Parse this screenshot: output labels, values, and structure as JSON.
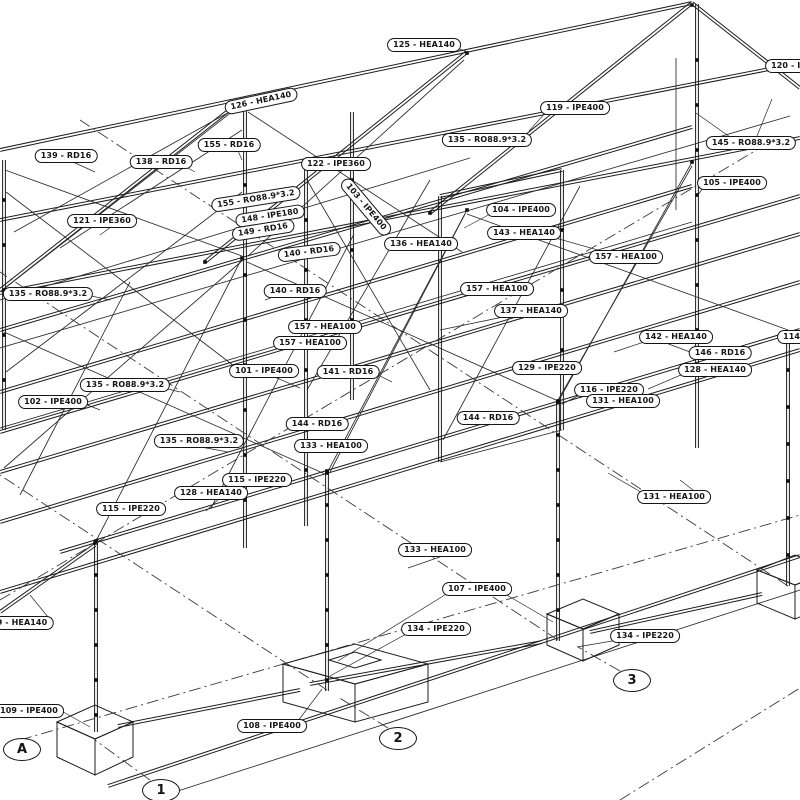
{
  "drawing": {
    "description": "3D isometric view of a structural steel frame with member callout labels and grid axis bubbles",
    "colors": {
      "line": "#1c1c1c",
      "background": "#ffffff",
      "label_border": "#151515"
    },
    "member_labels": [
      {
        "text": "125 - HEA140",
        "x": 424,
        "y": 45,
        "rot": 0
      },
      {
        "text": "126 - HEA140",
        "x": 261,
        "y": 101,
        "rot": -12
      },
      {
        "text": "119 - IPE400",
        "x": 575,
        "y": 108,
        "rot": 0
      },
      {
        "text": "120 - IPE400",
        "x": 800,
        "y": 66,
        "rot": 0
      },
      {
        "text": "139 - RD16",
        "x": 66,
        "y": 156,
        "rot": 0
      },
      {
        "text": "138 - RD16",
        "x": 161,
        "y": 162,
        "rot": 0
      },
      {
        "text": "155 - RD16",
        "x": 229,
        "y": 145,
        "rot": 0
      },
      {
        "text": "122 - IPE360",
        "x": 336,
        "y": 164,
        "rot": 0
      },
      {
        "text": "145 - RO88.9*3.2",
        "x": 751,
        "y": 143,
        "rot": 0
      },
      {
        "text": "105 - IPE400",
        "x": 732,
        "y": 183,
        "rot": 0
      },
      {
        "text": "121 - IPE360",
        "x": 102,
        "y": 221,
        "rot": 0
      },
      {
        "text": "135 - RO88.9*3.2",
        "x": 48,
        "y": 294,
        "rot": 0
      },
      {
        "text": "155 - RO88.9*3.2",
        "x": 256,
        "y": 199,
        "rot": -9
      },
      {
        "text": "148 - IPE180",
        "x": 270,
        "y": 216,
        "rot": -9
      },
      {
        "text": "149 - RD16",
        "x": 263,
        "y": 230,
        "rot": -9
      },
      {
        "text": "103 - IPE400",
        "x": 366,
        "y": 207,
        "rot": 50
      },
      {
        "text": "140 - RD16",
        "x": 309,
        "y": 252,
        "rot": -7
      },
      {
        "text": "140 - RD16",
        "x": 295,
        "y": 291,
        "rot": 0
      },
      {
        "text": "136 - HEA140",
        "x": 421,
        "y": 244,
        "rot": 0
      },
      {
        "text": "135 - RO88.9*3.2",
        "x": 487,
        "y": 140,
        "rot": 0
      },
      {
        "text": "104 - IPE400",
        "x": 521,
        "y": 210,
        "rot": 0
      },
      {
        "text": "143 - HEA140",
        "x": 524,
        "y": 233,
        "rot": 0
      },
      {
        "text": "157 - HEA100",
        "x": 626,
        "y": 257,
        "rot": 0
      },
      {
        "text": "157 - HEA100",
        "x": 497,
        "y": 289,
        "rot": 0
      },
      {
        "text": "137 - HEA140",
        "x": 531,
        "y": 311,
        "rot": 0
      },
      {
        "text": "157 - HEA100",
        "x": 325,
        "y": 327,
        "rot": 0
      },
      {
        "text": "157 - HEA100",
        "x": 310,
        "y": 343,
        "rot": 0
      },
      {
        "text": "142 - HEA140",
        "x": 676,
        "y": 337,
        "rot": 0
      },
      {
        "text": "146 - RD16",
        "x": 720,
        "y": 353,
        "rot": 0
      },
      {
        "text": "128 - HEA140",
        "x": 715,
        "y": 370,
        "rot": 0
      },
      {
        "text": "114 - IPE220",
        "x": 812,
        "y": 337,
        "rot": 0
      },
      {
        "text": "101 - IPE400",
        "x": 264,
        "y": 371,
        "rot": 0
      },
      {
        "text": "141 - RD16",
        "x": 348,
        "y": 372,
        "rot": 0
      },
      {
        "text": "129 - IPE220",
        "x": 547,
        "y": 368,
        "rot": 0
      },
      {
        "text": "116 - IPE220",
        "x": 609,
        "y": 390,
        "rot": 0
      },
      {
        "text": "131 - HEA100",
        "x": 623,
        "y": 401,
        "rot": 0
      },
      {
        "text": "102 - IPE400",
        "x": 53,
        "y": 402,
        "rot": 0
      },
      {
        "text": "135 - RO88.9*3.2",
        "x": 125,
        "y": 385,
        "rot": 0
      },
      {
        "text": "144 - RD16",
        "x": 488,
        "y": 418,
        "rot": 0
      },
      {
        "text": "144 - RD16",
        "x": 317,
        "y": 424,
        "rot": 0
      },
      {
        "text": "135 - RO88.9*3.2",
        "x": 199,
        "y": 441,
        "rot": 0
      },
      {
        "text": "133 - HEA100",
        "x": 331,
        "y": 446,
        "rot": 0
      },
      {
        "text": "115 - IPE220",
        "x": 257,
        "y": 480,
        "rot": 0
      },
      {
        "text": "128 - HEA140",
        "x": 211,
        "y": 493,
        "rot": 0
      },
      {
        "text": "115 - IPE220",
        "x": 131,
        "y": 509,
        "rot": 0
      },
      {
        "text": "131 - HEA100",
        "x": 674,
        "y": 497,
        "rot": 0
      },
      {
        "text": "133 - HEA100",
        "x": 435,
        "y": 550,
        "rot": 0
      },
      {
        "text": "107 - IPE400",
        "x": 477,
        "y": 589,
        "rot": 0
      },
      {
        "text": "134 - IPE220",
        "x": 436,
        "y": 629,
        "rot": 0
      },
      {
        "text": "134 - IPE220",
        "x": 645,
        "y": 636,
        "rot": 0
      },
      {
        "text": "9 - HEA140",
        "x": 22,
        "y": 623,
        "rot": 0
      },
      {
        "text": "109 - IPE400",
        "x": 29,
        "y": 711,
        "rot": 0
      },
      {
        "text": "108 - IPE400",
        "x": 272,
        "y": 726,
        "rot": 0
      }
    ],
    "grid_bubbles": [
      {
        "text": "A",
        "x": 21,
        "y": 748
      },
      {
        "text": "1",
        "x": 160,
        "y": 789
      },
      {
        "text": "2",
        "x": 397,
        "y": 737
      },
      {
        "text": "3",
        "x": 631,
        "y": 679
      }
    ]
  }
}
